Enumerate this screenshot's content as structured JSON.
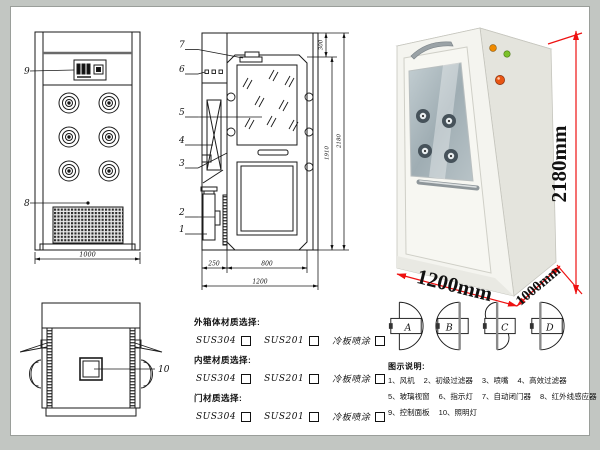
{
  "page": {
    "background": "#c2c6c2",
    "sheet": "#ffffff",
    "line_color": "#1a1a1a",
    "accent_red": "#ee1111"
  },
  "front_view": {
    "callout_panel": "9",
    "callout_grille": "8",
    "width_dim": "1000"
  },
  "side_view": {
    "callouts": [
      "7",
      "6",
      "5",
      "4",
      "3",
      "2",
      "1"
    ],
    "bottom_dims": [
      "250",
      "800",
      "1200"
    ],
    "right_dims": [
      "300",
      "1910",
      "2180"
    ]
  },
  "top_view": {
    "callout_light": "10"
  },
  "photo": {
    "height_label": "2180mm",
    "width_label": "1200mm",
    "depth_label": "1000mm"
  },
  "materials": {
    "groups": [
      {
        "label": "外箱体材质选择:",
        "options": [
          "SUS304",
          "SUS201",
          "冷板喷涂"
        ]
      },
      {
        "label": "内壁材质选择:",
        "options": [
          "SUS304",
          "SUS201",
          "冷板喷涂"
        ]
      },
      {
        "label": "门材质选择:",
        "options": [
          "SUS304",
          "SUS201",
          "冷板喷涂"
        ]
      }
    ]
  },
  "door_options": {
    "labels": [
      "A",
      "B",
      "C",
      "D"
    ]
  },
  "legend": {
    "title": "图示说明:",
    "rows": [
      [
        "1、风机",
        "2、初级过滤器",
        "3、喷嘴",
        "4、高效过滤器"
      ],
      [
        "5、玻璃视窗",
        "6、指示灯",
        "7、自动闭门器",
        "8、红外线感应器"
      ],
      [
        "9、控制面板",
        "10、照明灯"
      ]
    ]
  }
}
